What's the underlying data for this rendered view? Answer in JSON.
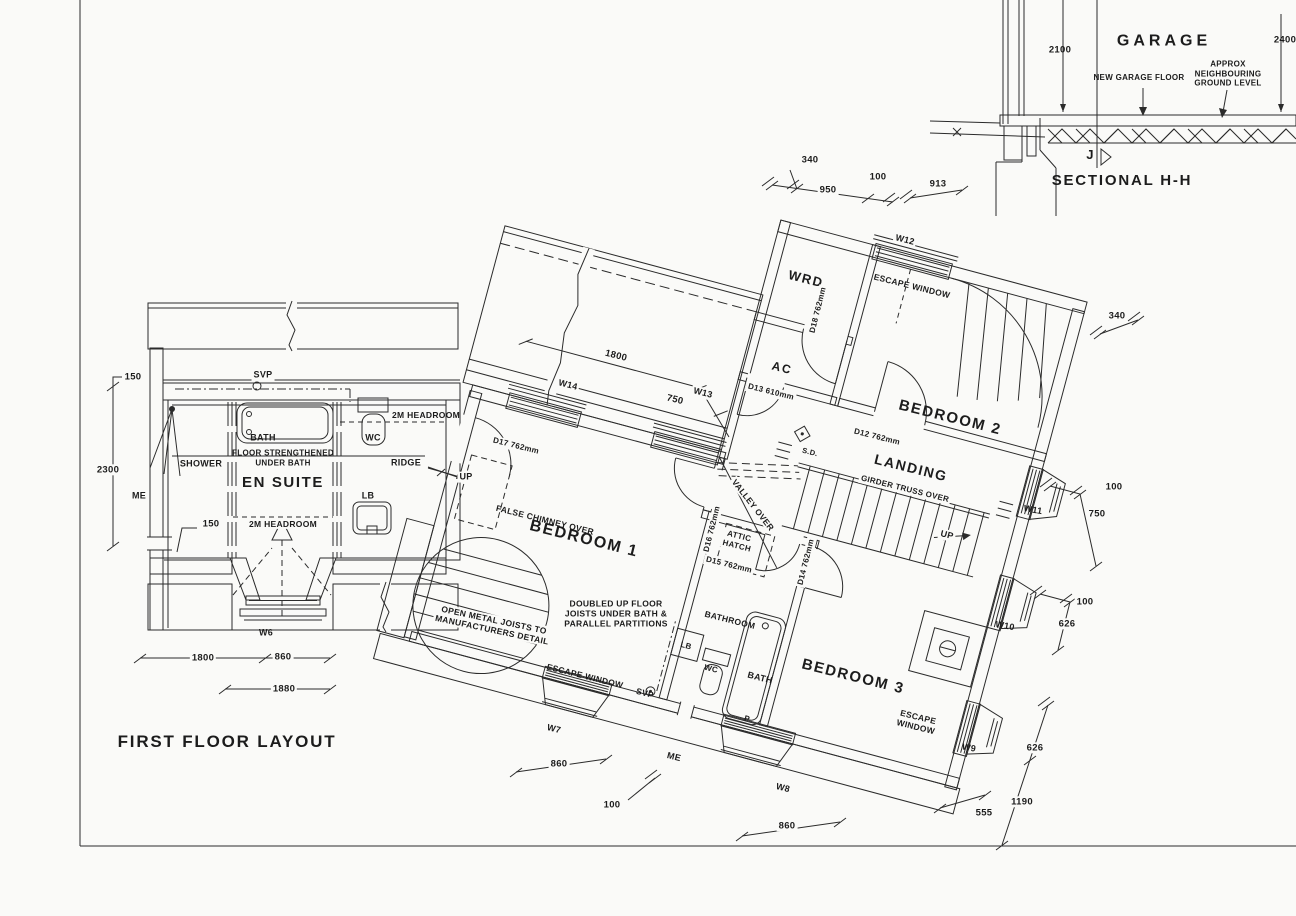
{
  "titles": {
    "plan": "FIRST FLOOR LAYOUT",
    "sectional": "SECTIONAL H-H",
    "garage": "GARAGE",
    "section_marker": "J"
  },
  "rooms": {
    "ensuite": "EN SUITE",
    "bedroom1": "BEDROOM 1",
    "bedroom2": "BEDROOM 2",
    "bedroom3": "BEDROOM 3",
    "landing": "LANDING",
    "bathroom": "BATHROOM",
    "wardrobe": "WRD",
    "airing_cupboard": "AC"
  },
  "fixtures": {
    "bath_ensuite": "BATH",
    "shower": "SHOWER",
    "wc_ensuite": "WC",
    "lb_ensuite": "LB",
    "bath_main": "BATH",
    "wc_main": "WC",
    "lb_main": "LB",
    "pump": "P",
    "svp_ensuite": "SVP",
    "svp_main": "SVP",
    "me_ensuite": "ME",
    "me_main": "ME",
    "smoke_detector": "S.D.",
    "up_ensuite": "UP",
    "up_stairs": "UP"
  },
  "windows": {
    "w6": "W6",
    "w7": "W7",
    "w8": "W8",
    "w9": "W9",
    "w10": "W10",
    "w11": "W11",
    "w12": "W12",
    "w13": "W13",
    "w14": "W14"
  },
  "doors": {
    "d12": "D12  762mm",
    "d13": "D13  610mm",
    "d14": "D14  762mm",
    "d15": "D15  762mm",
    "d16": "D16  762mm",
    "d17": "D17  762mm",
    "d18": "D18  762mm"
  },
  "notes": {
    "escape_window_w12": "ESCAPE  WINDOW",
    "escape_window_w7": "ESCAPE  WINDOW",
    "escape_window_w9": "ESCAPE\nWINDOW",
    "false_chimney": "FALSE CHIMNEY OVER",
    "attic_hatch": "ATTIC\nHATCH",
    "valley_over": "VALLEY OVER",
    "girder_truss": "GIRDER TRUSS OVER",
    "ridge": "RIDGE",
    "headroom_a": "2M HEADROOM",
    "headroom_b": "2M HEADROOM",
    "floor_strengthened": "FLOOR STRENGTHENED\nUNDER BATH",
    "open_joists": "OPEN  METAL  JOISTS  TO\nMANUFACTURERS  DETAIL",
    "doubled_joists": "DOUBLED UP FLOOR\nJOISTS UNDER BATH &\nPARALLEL PARTITIONS",
    "new_garage_floor": "NEW GARAGE FLOOR",
    "approx_ground": "APPROX NEIGHBOURING\nGROUND LEVEL"
  },
  "dims": {
    "top_340": "340",
    "top_950": "950",
    "top_100": "100",
    "top_913": "913",
    "sec_2100": "2100",
    "sec_2400": "2400",
    "right_340": "340",
    "right_100a": "100",
    "right_750": "750",
    "right_100b": "100",
    "right_626a": "626",
    "right_626b": "626",
    "right_1190": "1190",
    "right_555": "555",
    "bottom_860a": "860",
    "bottom_100": "100",
    "bottom_860b": "860",
    "left_150a": "150",
    "left_2300": "2300",
    "left_150b": "150",
    "left_1800": "1800",
    "left_860": "860",
    "left_1880": "1880",
    "roof_1800": "1800",
    "roof_750": "750"
  }
}
